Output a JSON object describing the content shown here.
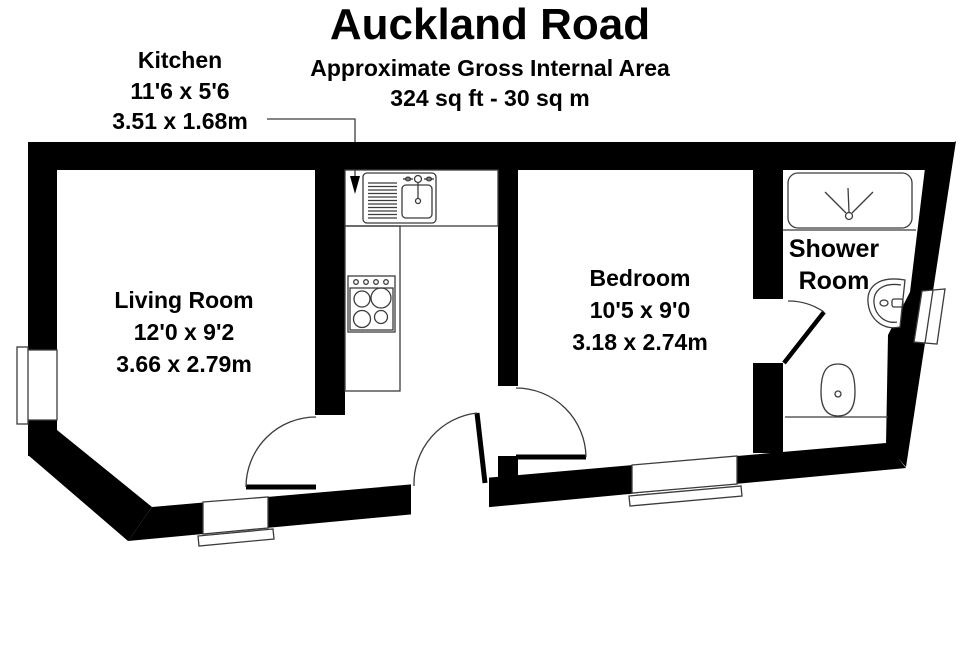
{
  "header": {
    "title": "Auckland Road",
    "subtitle": "Approximate Gross Internal Area",
    "area": "324 sq ft - 30 sq m"
  },
  "rooms": {
    "kitchen": {
      "name": "Kitchen",
      "size_imperial": "11'6 x 5'6",
      "size_metric": "3.51 x 1.68m"
    },
    "living_room": {
      "name": "Living Room",
      "size_imperial": "12'0 x 9'2",
      "size_metric": "3.66 x 2.79m"
    },
    "bedroom": {
      "name": "Bedroom",
      "size_imperial": "10'5 x 9'0",
      "size_metric": "3.18 x 2.74m"
    },
    "shower_room": {
      "name": "Shower Room"
    }
  },
  "fixtures": {
    "kitchen": [
      "sink-unit-with-drainer",
      "hob-four-burners"
    ],
    "shower_room": [
      "shower-tray",
      "wash-basin",
      "toilet"
    ]
  },
  "colors": {
    "wall": "#000000",
    "line": "#3c3c3c",
    "background": "#ffffff",
    "text": "#000000"
  }
}
